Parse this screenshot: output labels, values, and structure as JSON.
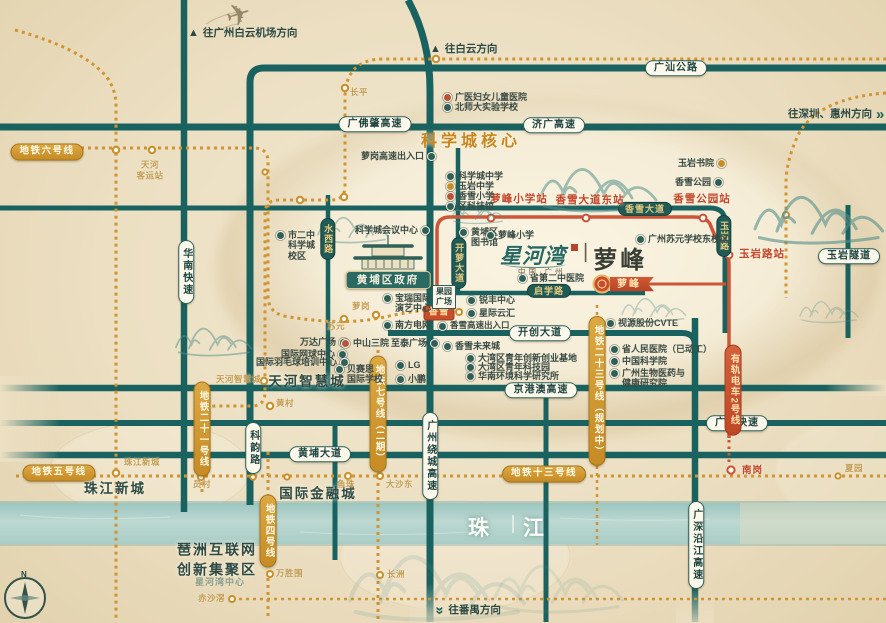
{
  "map": {
    "logo": {
      "brand": "星河湾",
      "divider": "|",
      "name": "萝峰",
      "subtitle": "中国·广州"
    },
    "river": "珠江",
    "compass": "N",
    "plane_icon": "✈",
    "labels": [
      {
        "name": "road-pill-guangshan-gonglu",
        "cls": "pillW c",
        "text": "广汕公路",
        "x": 676,
        "y": 68
      },
      {
        "name": "road-pill-guangfozhao-gaosu",
        "cls": "pillW c",
        "text": "广佛肇高速",
        "x": 375,
        "y": 124
      },
      {
        "name": "road-pill-jiguang-gaosu",
        "cls": "pillW c",
        "text": "济广高速",
        "x": 554,
        "y": 125
      },
      {
        "name": "road-pill-kaichuang-dadao",
        "cls": "pillW c",
        "text": "开创大道",
        "x": 540,
        "y": 333
      },
      {
        "name": "road-pill-jinggangao-gaosu",
        "cls": "pillW c",
        "text": "京港澳高速",
        "x": 541,
        "y": 390
      },
      {
        "name": "road-pill-guangyuan-kuaisu",
        "cls": "pillW c",
        "text": "广园快速",
        "x": 737,
        "y": 423
      },
      {
        "name": "road-pill-huangpu-dadao",
        "cls": "pillW c",
        "text": "黄埔大道",
        "x": 320,
        "y": 454
      },
      {
        "name": "road-pill-yuyan-suidao",
        "cls": "pillW c",
        "text": "玉岩隧道",
        "x": 849,
        "y": 256
      },
      {
        "name": "road-pill-huanan-kuaisu",
        "cls": "pillW v c",
        "text": "华南快速",
        "x": 186,
        "y": 272
      },
      {
        "name": "road-pill-keyun-lu",
        "cls": "pillW v c",
        "text": "科韵路",
        "x": 253,
        "y": 448
      },
      {
        "name": "road-pill-guangzhou-raocheng-gaosu",
        "cls": "pillW v c",
        "text": "广州绕城高速",
        "x": 430,
        "y": 456
      },
      {
        "name": "road-pill-guangshen-yanjiang-gaosu",
        "cls": "pillW v c",
        "text": "广深沿江高速",
        "x": 696,
        "y": 545
      },
      {
        "name": "road-pill-xiangxue-dadao",
        "cls": "pillD c",
        "text": "香雪大道",
        "x": 645,
        "y": 209
      },
      {
        "name": "road-pill-qixue-lu",
        "cls": "pillD c",
        "text": "启学路",
        "x": 549,
        "y": 291
      },
      {
        "name": "road-pill-yuyan-lu",
        "cls": "pillD v c",
        "text": "玉岩路",
        "x": 724,
        "y": 236
      },
      {
        "name": "road-pill-kailuo-dadao",
        "cls": "pillD v c",
        "text": "开萝大道",
        "x": 459,
        "y": 263
      },
      {
        "name": "road-pill-shuixi-lu",
        "cls": "pillD v c",
        "text": "水西路",
        "x": 328,
        "y": 239
      },
      {
        "name": "metro-badge-line6",
        "cls": "mbadge c",
        "text": "地铁六号线",
        "x": 47,
        "y": 152
      },
      {
        "name": "metro-badge-line5",
        "cls": "mbadge c",
        "text": "地铁五号线",
        "x": 59,
        "y": 473
      },
      {
        "name": "metro-badge-line13",
        "cls": "mbadge c",
        "text": "地铁十三号线",
        "x": 544,
        "y": 474
      },
      {
        "name": "metro-badge-line21",
        "cls": "mbadge v c",
        "text": "地铁二十一号线",
        "x": 202,
        "y": 429
      },
      {
        "name": "metro-badge-line4",
        "cls": "mbadge v c",
        "text": "地铁四号线",
        "x": 268,
        "y": 531
      },
      {
        "name": "metro-badge-line7-phase2",
        "cls": "mbadge v c",
        "text": "地铁七号线（二期）",
        "x": 378,
        "y": 414
      },
      {
        "name": "metro-badge-line23-planned",
        "cls": "mbadge v c",
        "text": "地铁二十三号线（规划中）",
        "x": 597,
        "y": 391
      },
      {
        "name": "tram-badge-line2",
        "cls": "rbadge v c",
        "text": "有轨电车2号线",
        "x": 733,
        "y": 390
      },
      {
        "name": "station-badge-xiangxue",
        "cls": "rsq c",
        "text": "香雪",
        "x": 439,
        "y": 313
      },
      {
        "name": "project-marker-icon",
        "cls": "marker c",
        "text": "",
        "x": 602,
        "y": 284
      },
      {
        "name": "project-ribbon-luofeng",
        "cls": "ribbon c",
        "text": "萝峰",
        "x": 632,
        "y": 284
      },
      {
        "name": "station-label-luofeng-xiaoxue",
        "cls": "rsta c",
        "text": "萝峰小学站",
        "x": 519,
        "y": 199
      },
      {
        "name": "station-label-xiangxue-dadao-dong",
        "cls": "rsta c",
        "text": "香雪大道东站",
        "x": 590,
        "y": 200
      },
      {
        "name": "station-label-xiangxue-gongyuan",
        "cls": "rsta c",
        "text": "香雪公园站",
        "x": 702,
        "y": 199
      },
      {
        "name": "station-label-yuyan-lu",
        "cls": "rsta c",
        "text": "玉岩路站",
        "x": 762,
        "y": 254
      },
      {
        "name": "station-label-nangang",
        "cls": "rsta sm",
        "text": "南岗",
        "x": 742,
        "y": 466
      },
      {
        "name": "science-city-core-label",
        "cls": "ohead c",
        "text": "科学城核心",
        "x": 471,
        "y": 142
      },
      {
        "name": "district-tianhe-zhihuicheng",
        "cls": "city c",
        "text": "天河智慧城",
        "x": 307,
        "y": 382
      },
      {
        "name": "district-intl-finance-city",
        "cls": "city c",
        "text": "国际金融城",
        "x": 318,
        "y": 494
      },
      {
        "name": "district-zhujiang-xincheng",
        "cls": "city c",
        "text": "珠江新城",
        "x": 115,
        "y": 489
      },
      {
        "name": "district-pazhou-cluster",
        "cls": "city two c",
        "lines": [
          "琶洲互联网",
          "创新集聚区"
        ],
        "x": 217,
        "y": 560
      },
      {
        "name": "direction-baiyun-airport",
        "cls": "dir",
        "ar": "▲",
        "side": "l",
        "text": "往广州白云机场方向",
        "x": 188,
        "y": 27
      },
      {
        "name": "direction-baiyun",
        "cls": "dir",
        "ar": "▲",
        "side": "l",
        "text": "往白云方向",
        "x": 430,
        "y": 43
      },
      {
        "name": "direction-shenzhen-huizhou",
        "cls": "dir right",
        "ar": "»",
        "side": "r",
        "text": "往深圳、惠州方向",
        "x": 788,
        "y": 107
      },
      {
        "name": "direction-panyu",
        "cls": "dir down",
        "ar": "»",
        "side": "l",
        "text": "往番禺方向",
        "x": 436,
        "y": 603
      },
      {
        "name": "poi-guangyi-womens-childrens-hospital",
        "cls": "poi",
        "ic": "#b8543a",
        "side": "l",
        "text": "广医妇女儿童医院",
        "x": 443,
        "y": 92
      },
      {
        "name": "poi-beishida-experimental-school",
        "cls": "poi",
        "ic": "#2f5f57",
        "side": "l",
        "text": "北师大实验学校",
        "x": 443,
        "y": 102
      },
      {
        "name": "poi-science-city-middle-school",
        "cls": "poi",
        "ic": "#2f5f57",
        "side": "l",
        "text": "科学城中学",
        "x": 446,
        "y": 171
      },
      {
        "name": "poi-yuyan-middle-school",
        "cls": "poi",
        "ic": "#c78e27",
        "side": "l",
        "text": "玉岩中学",
        "x": 446,
        "y": 181
      },
      {
        "name": "poi-xiangxue-primary-school",
        "cls": "poi",
        "ic": "#b8543a",
        "side": "l",
        "text": "香雪小学",
        "x": 446,
        "y": 191
      },
      {
        "name": "poi-district-science-museum",
        "cls": "poi",
        "ic": "#2f5f57",
        "side": "l",
        "text": "区科技馆",
        "x": 446,
        "y": 201
      },
      {
        "name": "poi-huangpu-library",
        "cls": "poi",
        "side": "l",
        "lines": [
          "黄埔区",
          "图书馆"
        ],
        "x": 459,
        "y": 227
      },
      {
        "name": "poi-luofeng-primary-school",
        "cls": "poi",
        "side": "l",
        "text": "萝峰小学",
        "x": 486,
        "y": 230
      },
      {
        "name": "poi-suyuan-school-east-campus",
        "cls": "poi",
        "side": "l",
        "text": "广州苏元学校东校区",
        "x": 636,
        "y": 234
      },
      {
        "name": "poi-yuyan-academy",
        "cls": "poi",
        "ic": "#c78e27",
        "side": "r",
        "text": "玉岩书院",
        "x": 678,
        "y": 158
      },
      {
        "name": "poi-xiangxue-park",
        "cls": "poi",
        "ic": "#2f5f57",
        "side": "r",
        "text": "香雪公园",
        "x": 675,
        "y": 177
      },
      {
        "name": "poi-second-tcm-hospital",
        "cls": "poi",
        "side": "l",
        "text": "省第二中医院",
        "x": 518,
        "y": 273
      },
      {
        "name": "poi-science-city-convention-center",
        "cls": "poi",
        "side": "r",
        "text": "科学城会议中心",
        "x": 355,
        "y": 225
      },
      {
        "name": "poi-no2-middle-school-campus",
        "cls": "poi",
        "side": "l",
        "lines": [
          "市二中",
          "科学城",
          "校区"
        ],
        "x": 276,
        "y": 230
      },
      {
        "name": "poi-baorui-performing-arts-center",
        "cls": "poi",
        "side": "l",
        "lines": [
          "宝瑞国际",
          "演艺中心"
        ],
        "x": 383,
        "y": 293
      },
      {
        "name": "poi-guoyuan-plaza",
        "cls": "box c",
        "lines": [
          "果园",
          "广场"
        ],
        "x": 444,
        "y": 297
      },
      {
        "name": "poi-ruifeng-center",
        "cls": "poi",
        "side": "l",
        "text": "锐丰中心",
        "x": 467,
        "y": 295
      },
      {
        "name": "poi-xingji-yunhui",
        "cls": "poi",
        "side": "l",
        "text": "星际云汇",
        "x": 467,
        "y": 308
      },
      {
        "name": "poi-southern-power-grid",
        "cls": "poi",
        "side": "l",
        "text": "南方电网",
        "x": 383,
        "y": 320
      },
      {
        "name": "poi-xiangxue-expressway-entrance",
        "cls": "poi sm",
        "side": "l",
        "text": "香雪高速出入口",
        "x": 438,
        "y": 321
      },
      {
        "name": "poi-luogang-expressway-entrance",
        "cls": "poi",
        "side": "r",
        "text": "萝岗高速出入口",
        "x": 361,
        "y": 151
      },
      {
        "name": "poi-zhitai-plaza",
        "cls": "poi",
        "side": "r",
        "text": "至泰广场",
        "x": 391,
        "y": 338
      },
      {
        "name": "poi-wanda-plaza",
        "cls": "poi",
        "side": "r",
        "text": "万达广场",
        "x": 300,
        "y": 337
      },
      {
        "name": "poi-zhongshan-third-hospital",
        "cls": "poi",
        "ic": "#b8543a",
        "side": "l",
        "text": "中山三院",
        "x": 341,
        "y": 338
      },
      {
        "name": "poi-intl-tennis-center",
        "cls": "poi",
        "side": "r",
        "text": "国际网球中心",
        "x": 281,
        "y": 349
      },
      {
        "name": "poi-intl-badminton-training-center",
        "cls": "poi",
        "side": "r",
        "text": "国际羽毛球培训中心",
        "x": 256,
        "y": 357
      },
      {
        "name": "poi-basis-intl-school",
        "cls": "poi",
        "side": "l",
        "lines": [
          "贝赛思",
          "国际学校"
        ],
        "x": 335,
        "y": 364
      },
      {
        "name": "poi-lg",
        "cls": "poi",
        "side": "l",
        "text": "LG",
        "x": 396,
        "y": 360
      },
      {
        "name": "poi-xpeng",
        "cls": "poi",
        "side": "l",
        "text": "小鹏",
        "x": 396,
        "y": 374
      },
      {
        "name": "poi-xiangxue-future-city",
        "cls": "poi",
        "side": "l",
        "text": "香雪未来城",
        "x": 443,
        "y": 341
      },
      {
        "name": "poi-gba-youth-innovation-base",
        "cls": "poi",
        "side": "l",
        "text": "大湾区青年创新创业基地",
        "x": 466,
        "y": 353
      },
      {
        "name": "poi-gba-youth-tech-park",
        "cls": "poi",
        "side": "l",
        "text": "大湾区青年科技园",
        "x": 466,
        "y": 362
      },
      {
        "name": "poi-south-china-environment-institute",
        "cls": "poi",
        "side": "l",
        "text": "华南环境科学研究所",
        "x": 466,
        "y": 371
      },
      {
        "name": "poi-cvte",
        "cls": "poi",
        "side": "l",
        "text": "视源股份CVTE",
        "x": 606,
        "y": 318
      },
      {
        "name": "poi-provincial-peoples-hospital",
        "cls": "poi",
        "side": "l",
        "text": "省人民医院（已动工）",
        "x": 610,
        "y": 344
      },
      {
        "name": "poi-chinese-academy-of-sciences",
        "cls": "poi",
        "side": "l",
        "text": "中国科学院",
        "x": 610,
        "y": 356
      },
      {
        "name": "poi-gz-biomedicine-health-institute",
        "cls": "poi",
        "side": "l",
        "lines": [
          "广州生物医药与",
          "健康研究院"
        ],
        "x": 610,
        "y": 368
      },
      {
        "name": "government-badge-huangpu",
        "cls": "govt c",
        "text": "黄埔区政府",
        "x": 388,
        "y": 280
      },
      {
        "name": "station-faint-tianhe-coach-terminal",
        "cls": "fgold two c",
        "lines": [
          "天河",
          "客运站"
        ],
        "x": 150,
        "y": 170
      },
      {
        "name": "station-faint-changping",
        "cls": "fgold",
        "text": "长平",
        "x": 350,
        "y": 88
      },
      {
        "name": "station-faint-luogang",
        "cls": "fgold",
        "text": "萝岗",
        "x": 352,
        "y": 302
      },
      {
        "name": "station-faint-suyuan",
        "cls": "fgold",
        "text": "苏元",
        "x": 327,
        "y": 322
      },
      {
        "name": "station-faint-tianhe-zhihuicheng",
        "cls": "fgold",
        "text": "天河智慧城",
        "x": 216,
        "y": 375
      },
      {
        "name": "station-faint-huangcun",
        "cls": "fgold",
        "text": "黄村",
        "x": 276,
        "y": 399
      },
      {
        "name": "station-faint-yuancun",
        "cls": "fgold",
        "text": "员村",
        "x": 193,
        "y": 480
      },
      {
        "name": "station-faint-zhujiang-xincheng",
        "cls": "fgold",
        "text": "珠江新城",
        "x": 124,
        "y": 458
      },
      {
        "name": "station-faint-yuzhu",
        "cls": "fgold",
        "text": "鱼珠",
        "x": 337,
        "y": 480
      },
      {
        "name": "station-faint-dashadong",
        "cls": "fgold",
        "text": "大沙东",
        "x": 386,
        "y": 480
      },
      {
        "name": "station-faint-wanshengwei",
        "cls": "fgold",
        "text": "万胜围",
        "x": 276,
        "y": 569
      },
      {
        "name": "station-faint-changzhou",
        "cls": "fgold",
        "text": "长洲",
        "x": 387,
        "y": 570
      },
      {
        "name": "station-faint-chishajiao",
        "cls": "fgold",
        "text": "赤沙滘",
        "x": 198,
        "y": 594
      },
      {
        "name": "station-faint-xiayuan",
        "cls": "fgold",
        "text": "夏园",
        "x": 845,
        "y": 464
      },
      {
        "name": "brand-watermark",
        "cls": "wmk c",
        "text": "星河湾中心",
        "x": 220,
        "y": 582
      }
    ]
  }
}
